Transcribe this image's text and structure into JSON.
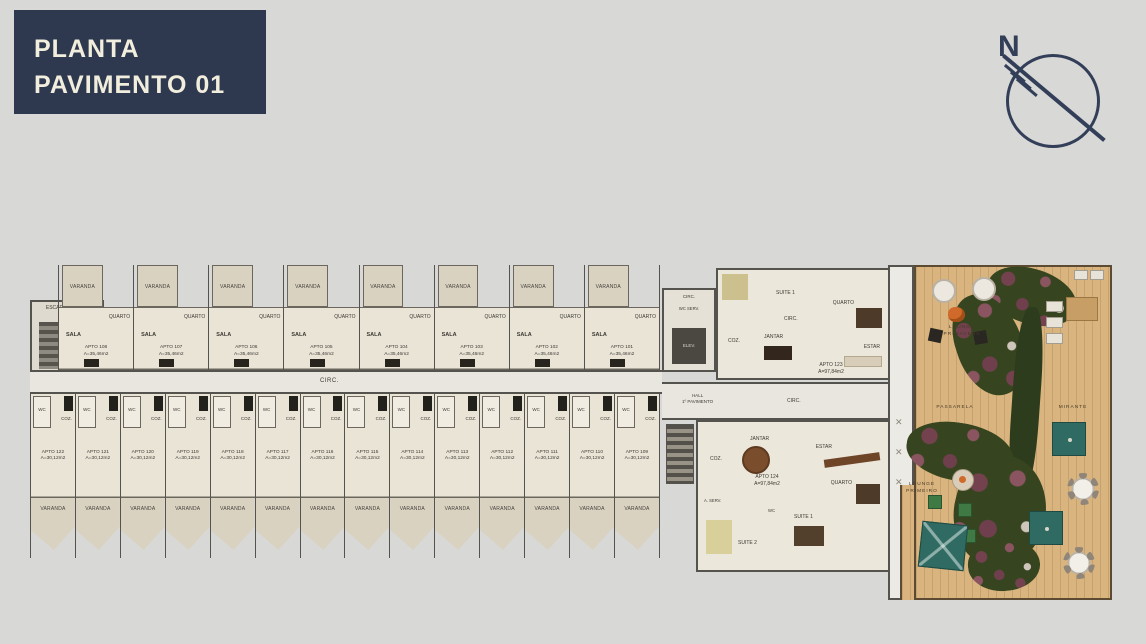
{
  "title_block": {
    "line1": "PLANTA",
    "line2": "PAVIMENTO 01",
    "bg": "#2e3950",
    "text_color": "#f2eedd"
  },
  "north_label": "N",
  "plan": {
    "stairs_label_1": "ESCADA",
    "stairs_label_2": "INCÊND.",
    "corridor_label": "CIRC.",
    "hall_label_1": "HALL",
    "hall_label_2": "1º PAVIMENTO",
    "hall_circ_label": "CIRC.",
    "core": {
      "circ": "CIRC.",
      "wc_serv": "WC SERV.",
      "elev": "ELEV."
    },
    "room_labels": {
      "sala": "SALA",
      "quarto": "QUARTO",
      "varanda": "VARANDA",
      "wc": "WC",
      "coz": "COZ."
    },
    "top_units": [
      {
        "apto": "APTO 108",
        "area": "A=35,46m2"
      },
      {
        "apto": "APTO 107",
        "area": "A=35,46m2"
      },
      {
        "apto": "APTO 106",
        "area": "A=35,46m2"
      },
      {
        "apto": "APTO 105",
        "area": "A=35,46m2"
      },
      {
        "apto": "APTO 104",
        "area": "A=35,46m2"
      },
      {
        "apto": "APTO 103",
        "area": "A=35,46m2"
      },
      {
        "apto": "APTO 102",
        "area": "A=35,46m2"
      },
      {
        "apto": "APTO 101",
        "area": "A=35,46m2"
      }
    ],
    "bottom_units": [
      {
        "apto": "APTO 122",
        "area": "A=30,12m2"
      },
      {
        "apto": "APTO 121",
        "area": "A=30,12m2"
      },
      {
        "apto": "APTO 120",
        "area": "A=30,12m2"
      },
      {
        "apto": "APTO 119",
        "area": "A=30,12m2"
      },
      {
        "apto": "APTO 118",
        "area": "A=30,12m2"
      },
      {
        "apto": "APTO 117",
        "area": "A=30,12m2"
      },
      {
        "apto": "APTO 116",
        "area": "A=30,12m2"
      },
      {
        "apto": "APTO 115",
        "area": "A=30,12m2"
      },
      {
        "apto": "APTO 114",
        "area": "A=30,12m2"
      },
      {
        "apto": "APTO 113",
        "area": "A=30,12m2"
      },
      {
        "apto": "APTO 112",
        "area": "A=30,12m2"
      },
      {
        "apto": "APTO 111",
        "area": "A=30,12m2"
      },
      {
        "apto": "APTO 110",
        "area": "A=30,12m2"
      },
      {
        "apto": "APTO 109",
        "area": "A=30,12m2"
      }
    ],
    "apt_upper": {
      "apto": "APTO 123",
      "area": "A=97,84m2",
      "suite2": "SUITE 2",
      "suite1": "SUITE 1",
      "quarto": "QUARTO",
      "circ": "CIRC.",
      "coz": "COZ.",
      "jantar": "JANTAR",
      "estar": "ESTAR"
    },
    "apt_lower": {
      "apto": "APTO 124",
      "area": "A=97,84m2",
      "jantar": "JANTAR",
      "coz": "COZ.",
      "estar": "ESTAR",
      "quarto": "QUARTO",
      "suite1": "SUITE 1",
      "suite2": "SUITE 2",
      "aserv": "A. SERV.",
      "wc": "WC"
    },
    "amenities": {
      "lounge_top_1": "LOUNGE",
      "lounge_top_2": "PRIMAVERA",
      "passarela": "PASSARELA",
      "mirante": "MIRANTE",
      "lounge_bottom_1": "LOUNGE",
      "lounge_bottom_2": "PRIMEIRO"
    }
  },
  "colors": {
    "navy": "#2e3950",
    "cream": "#f2eedd",
    "floor": "#eae4d7",
    "varanda": "#d9d2c1",
    "wall": "#55534e",
    "deck_wood": "#d9b47e",
    "vegetation": "#36451f",
    "flower": "#6f3f4e",
    "teal": "#2f6b62",
    "firepit": "#cf6a2a"
  }
}
